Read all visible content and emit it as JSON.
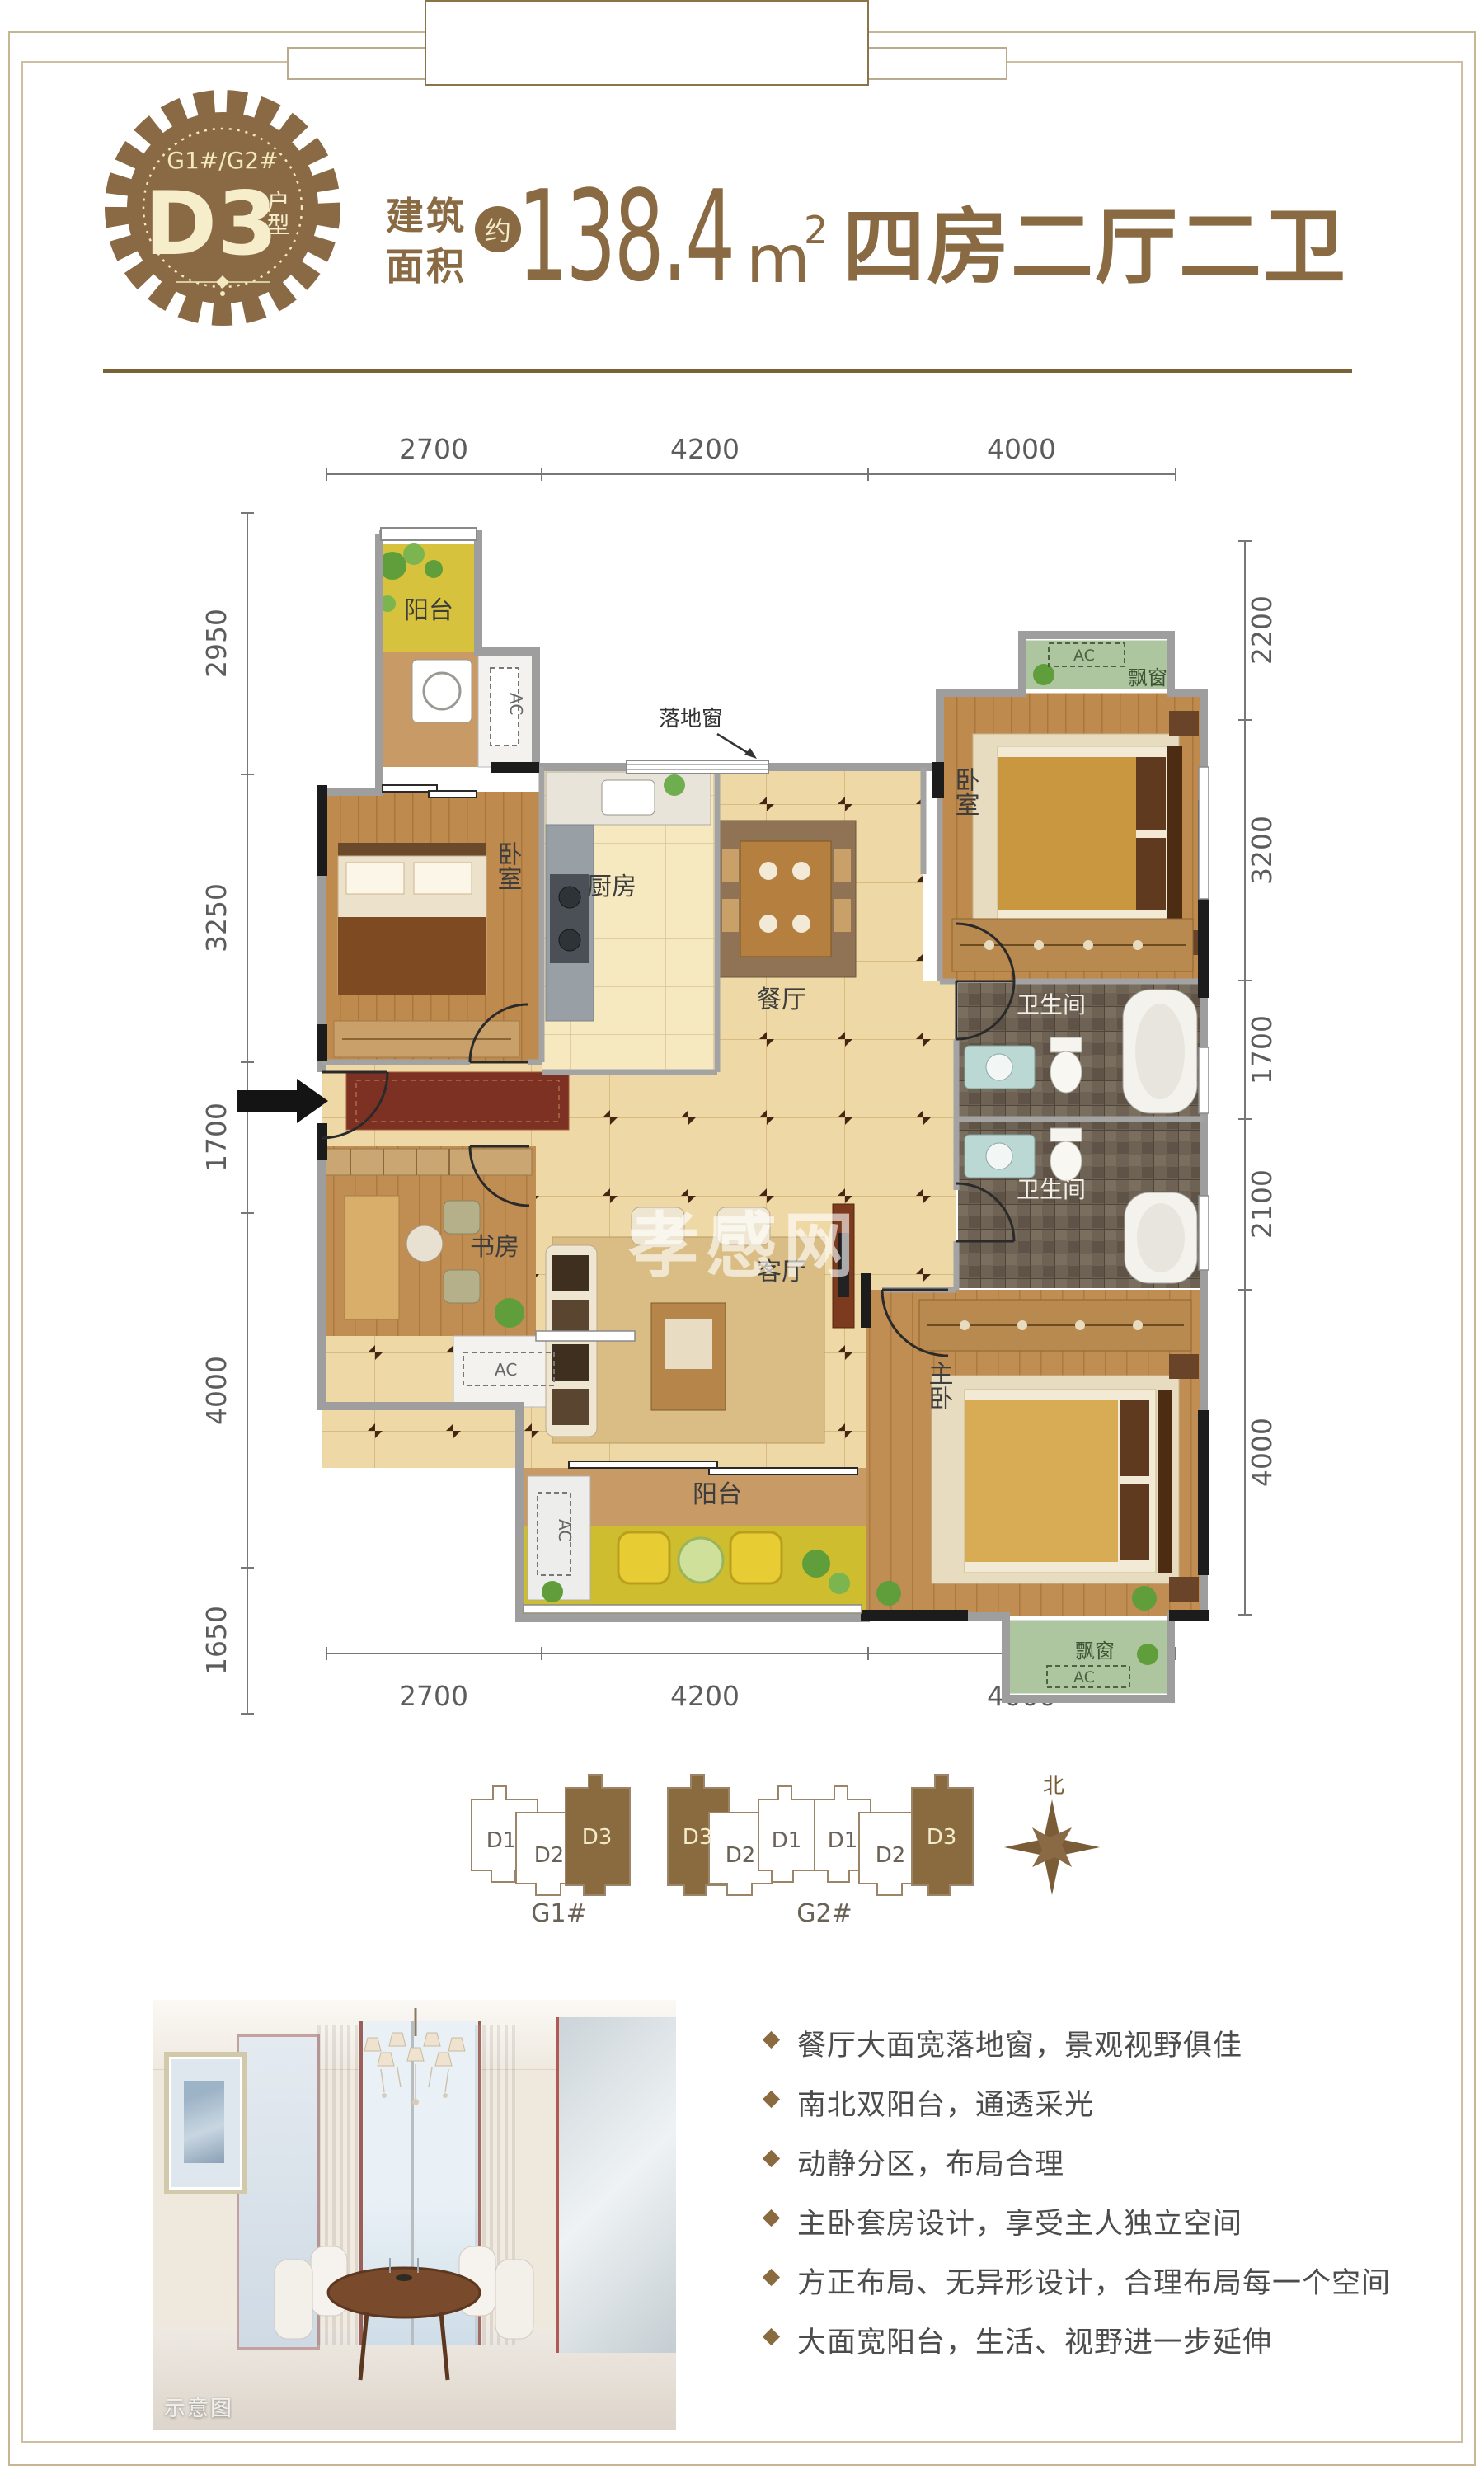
{
  "badge": {
    "building_codes": "G1#/G2#",
    "unit": "D3",
    "unit_type_suffix": "户型"
  },
  "header": {
    "area_label_top": "建筑",
    "area_label_bottom": "面积",
    "approx_badge": "约",
    "area_value": "138.4",
    "area_unit": "m",
    "area_unit_sup": "2",
    "layout_summary": "四房二厅二卫"
  },
  "colors": {
    "brand_brown": "#8a6a42",
    "badge_text": "#f3ecca",
    "divider": "#7a6234",
    "bullet": "#8a6a3f"
  },
  "floor_plan": {
    "watermark": "孝感网",
    "annotations": {
      "floor_window": "落地窗",
      "ac": "AC",
      "bay_window": "飘窗"
    },
    "rooms": {
      "balcony_north": "阳台",
      "bedroom_left": "卧室",
      "kitchen": "厨房",
      "dining": "餐厅",
      "bedroom_right": "卧室",
      "bath_upper": "卫生间",
      "bath_lower": "卫生间",
      "study": "书房",
      "living": "客厅",
      "master_bedroom": "主卧",
      "balcony_south": "阳台",
      "bay_window_bottom": "飘窗"
    },
    "dimensions": {
      "top": [
        "2700",
        "4200",
        "4000"
      ],
      "bottom": [
        "2700",
        "4200",
        "4000"
      ],
      "left": [
        "2950",
        "3250",
        "1700",
        "4000",
        "1650"
      ],
      "right": [
        "2200",
        "3200",
        "1700",
        "2100",
        "4000"
      ]
    }
  },
  "site_plan": {
    "buildings": [
      {
        "label": "G1#",
        "units": [
          "D1",
          "D2",
          "D3"
        ]
      },
      {
        "label": "G2#",
        "units": [
          "D3",
          "D2",
          "D1",
          "D1",
          "D2",
          "D3"
        ]
      }
    ],
    "highlighted_unit": "D3",
    "north_label": "北"
  },
  "photo": {
    "caption": "示意图"
  },
  "features": [
    "餐厅大面宽落地窗，景观视野俱佳",
    "南北双阳台，通透采光",
    "动静分区，布局合理",
    "主卧套房设计，享受主人独立空间",
    "方正布局、无异形设计，合理布局每一个空间",
    "大面宽阳台，生活、视野进一步延伸"
  ]
}
